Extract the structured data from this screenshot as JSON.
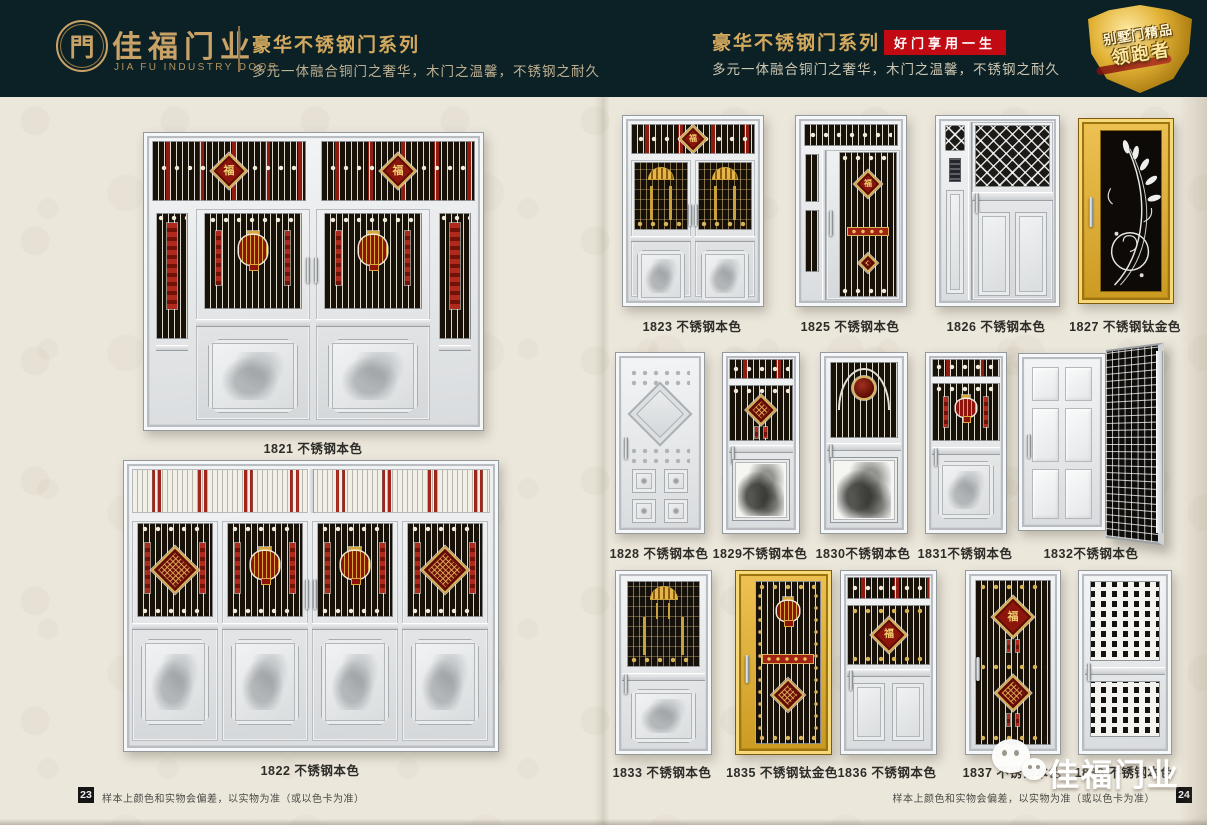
{
  "header": {
    "logo": {
      "glyph": "門",
      "brand": "佳福门业",
      "brand_en": "JIA FU INDUSTRY DOOR"
    },
    "left_section": {
      "series_title": "豪华不锈钢门系列",
      "tagline": "多元一体融合铜门之奢华，木门之温馨，不锈钢之耐久"
    },
    "right_section": {
      "series_title": "豪华不锈钢门系列",
      "slogan_badge": "好门享用一生",
      "tagline": "多元一体融合铜门之奢华，木门之温馨，不锈钢之耐久"
    },
    "shield_badge": {
      "line1": "别墅门精品",
      "line2": "领跑者"
    }
  },
  "decor": {
    "fu": "福"
  },
  "left_page": {
    "doors": [
      {
        "label": "1821 不锈钢本色"
      },
      {
        "label": "1822 不锈钢本色"
      }
    ],
    "footer": {
      "page_number": "23",
      "note": "样本上颜色和实物会偏差，以实物为准（或以色卡为准）"
    }
  },
  "right_page": {
    "rows": [
      {
        "doors": [
          {
            "label": "1823 不锈钢本色"
          },
          {
            "label": "1825 不锈钢本色"
          },
          {
            "label": "1826 不锈钢本色"
          },
          {
            "label": "1827 不锈钢钛金色"
          }
        ]
      },
      {
        "doors": [
          {
            "label": "1828 不锈钢本色"
          },
          {
            "label": "1829不锈钢本色"
          },
          {
            "label": "1830不锈钢本色"
          },
          {
            "label": "1831不锈钢本色"
          },
          {
            "label": "1832不锈钢本色"
          }
        ]
      },
      {
        "doors": [
          {
            "label": "1833 不锈钢本色"
          },
          {
            "label": "1835 不锈钢钛金色"
          },
          {
            "label": "1836 不锈钢本色"
          },
          {
            "label": "1837 不锈钢本色"
          },
          {
            "label": "1838 不锈钢本色"
          }
        ]
      }
    ],
    "footer": {
      "page_number": "24",
      "note": "样本上颜色和实物会偏差，以实物为准（或以色卡为准）"
    },
    "watermark": {
      "text": "佳福门业"
    }
  },
  "colors": {
    "header_bg": "#0c2125",
    "gold_accent": "#c9a268",
    "badge_red": "#c10a12",
    "page_bg": "#ece7db",
    "ornament_red": "#8c150c",
    "titanium_gold": "#d8a52c"
  }
}
